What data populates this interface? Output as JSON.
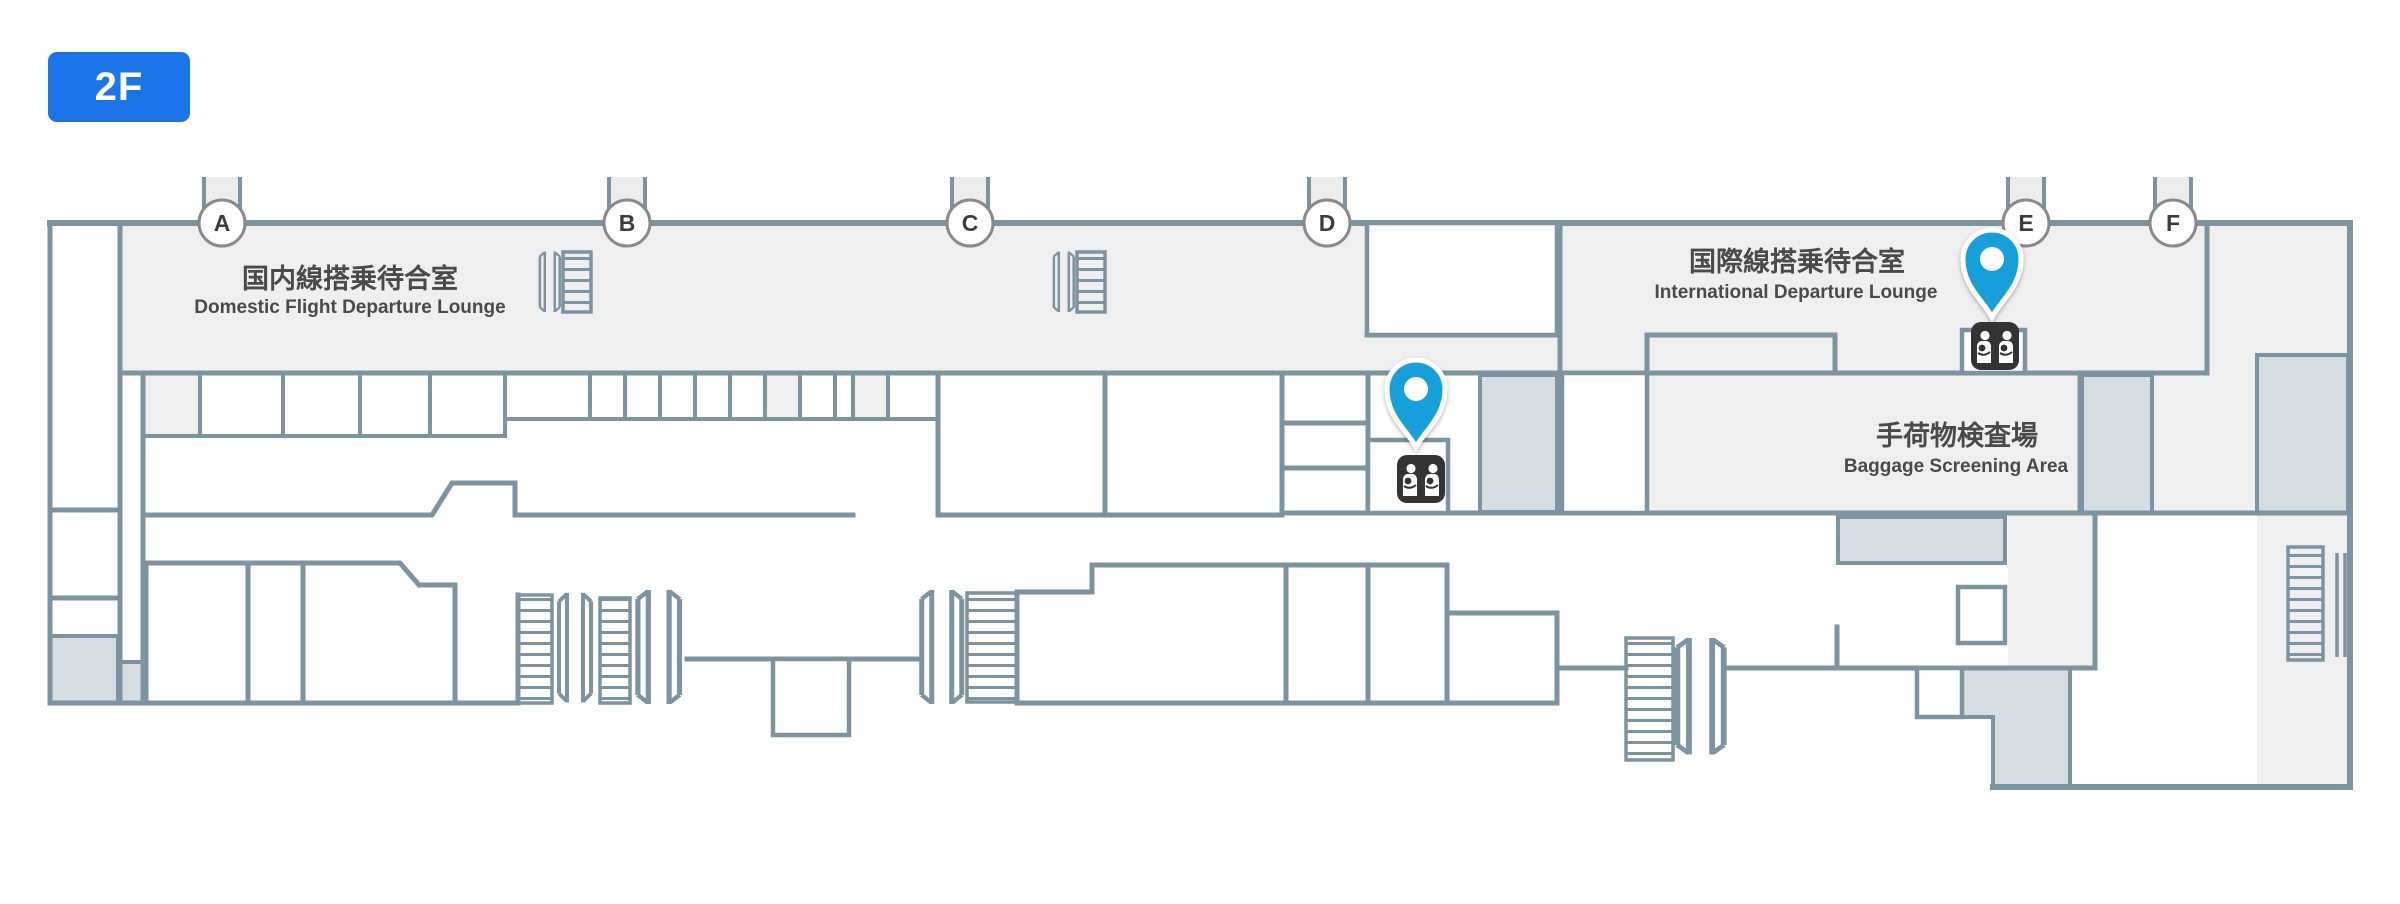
{
  "floor_badge": {
    "label": "2F"
  },
  "map": {
    "gates": [
      {
        "label": "A"
      },
      {
        "label": "B"
      },
      {
        "label": "C"
      },
      {
        "label": "D"
      },
      {
        "label": "E"
      },
      {
        "label": "F"
      }
    ],
    "areas": {
      "domestic_lounge": {
        "jp": "国内線搭乗待合室",
        "en": "Domestic Flight Departure Lounge"
      },
      "international_lounge": {
        "jp": "国際線搭乗待合室",
        "en": "International Departure Lounge"
      },
      "baggage_screening": {
        "jp": "手荷物検査場",
        "en": "Baggage Screening Area"
      }
    },
    "pins": [
      {
        "id": "nursing-room-near-gate-d",
        "type": "nursing-room"
      },
      {
        "id": "nursing-room-near-gate-e",
        "type": "nursing-room"
      }
    ],
    "colors": {
      "badge_blue": "#1c75e8",
      "pin_blue": "#199fd9",
      "wall": "#7d93a0",
      "room_light": "#efefef",
      "room_shaded": "#d5dde0",
      "icon_dark": "#333333",
      "label_text": "#4a4a4a"
    }
  }
}
